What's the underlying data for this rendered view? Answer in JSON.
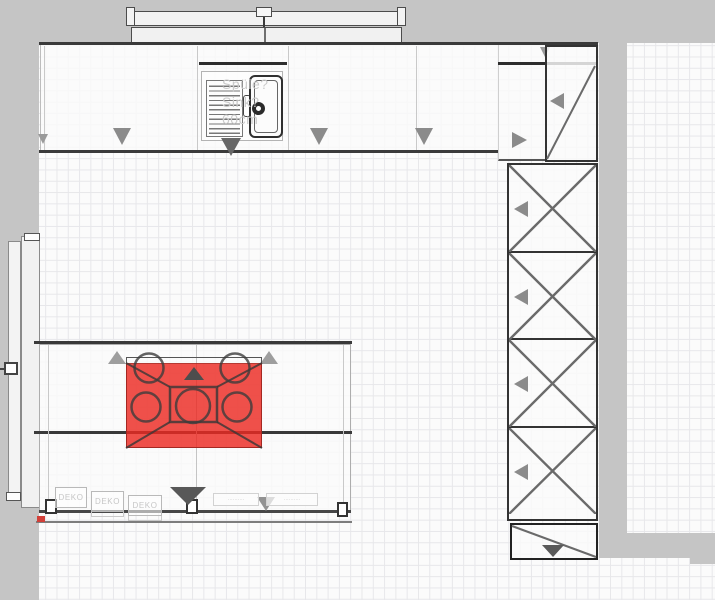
{
  "labels": {
    "sink": {
      "l1": "Spüle?",
      "l2": "Sink?",
      "l3": "60cm"
    },
    "deko": [
      "DEKO",
      "DEKO",
      "DEKO"
    ],
    "drawers": [
      "··········",
      "··········"
    ]
  },
  "colors": {
    "selection_red": "#ec2a22",
    "wall_gray": "#c5c5c5",
    "line_dark": "#3a3a3a",
    "arrow_gray": "#8b8b8b",
    "grid_line": "#e7e7ea"
  },
  "icons": {
    "door_swing_arrow": "triangle-down",
    "door_side_arrow": "triangle-left",
    "open_direction_arrow": "triangle-up",
    "tall_unit_cross": "x-cross",
    "corner_unit_diagonal": "diagonal-line"
  }
}
